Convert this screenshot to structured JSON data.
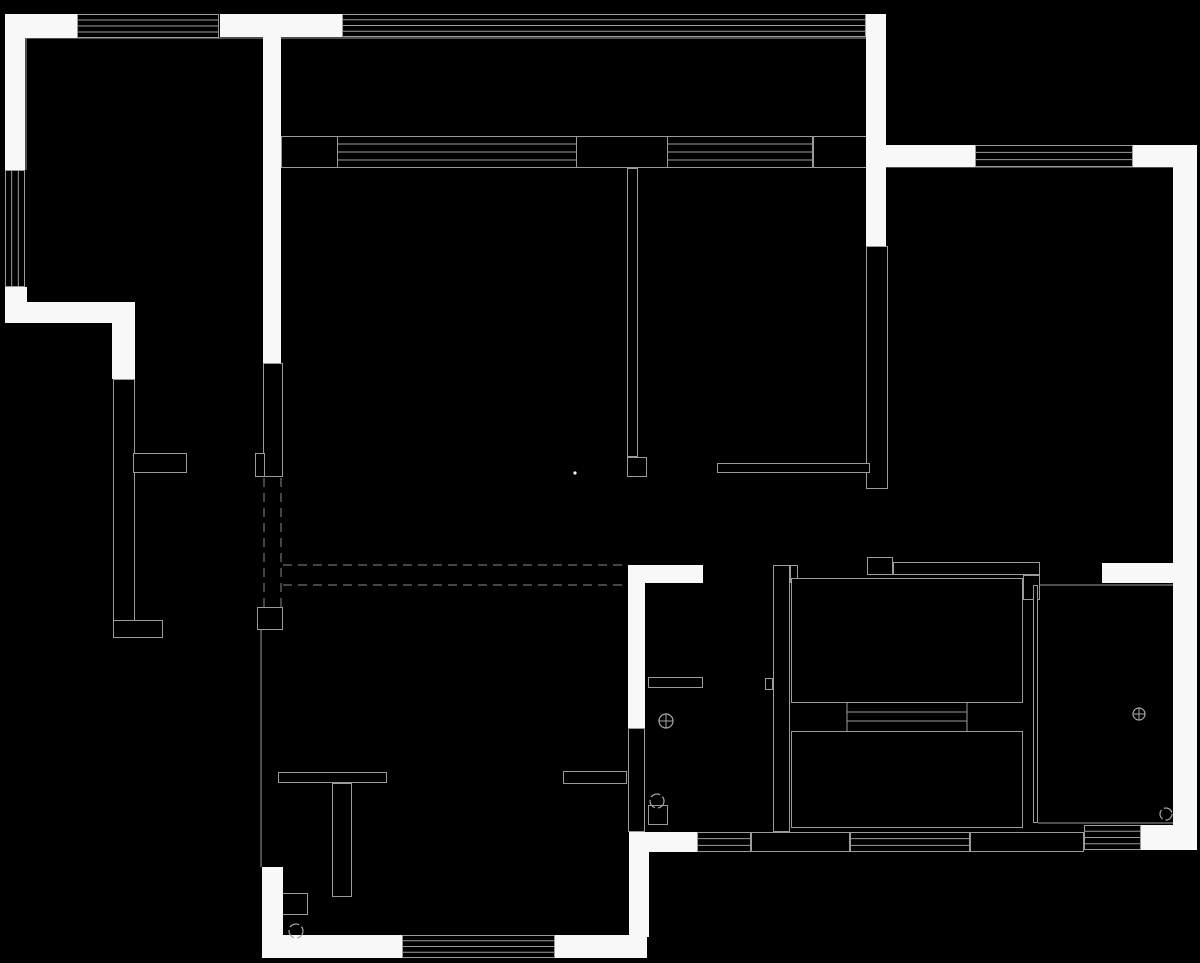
{
  "canvas": {
    "width": 1200,
    "height": 963
  },
  "colors": {
    "background": "#000000",
    "wall_fill": "#f8f8f8",
    "line": "#9b9b9b",
    "dash": "#8a8a8a",
    "symbol": "#a8a8a8"
  },
  "plan": {
    "white_walls": [
      [
        5,
        14,
        72,
        24
      ],
      [
        5,
        14,
        20,
        156
      ],
      [
        5,
        287,
        22,
        36
      ],
      [
        5,
        302,
        130,
        21
      ],
      [
        112,
        323,
        23,
        56
      ],
      [
        220,
        14,
        122,
        23
      ],
      [
        263,
        35,
        18,
        328
      ],
      [
        866,
        14,
        20,
        232
      ],
      [
        886,
        145,
        89,
        22
      ],
      [
        1133,
        145,
        60,
        22
      ],
      [
        1173,
        145,
        24,
        705
      ],
      [
        1102,
        563,
        71,
        20
      ],
      [
        1141,
        825,
        56,
        25
      ],
      [
        628,
        565,
        75,
        18
      ],
      [
        628,
        565,
        17,
        163
      ],
      [
        629,
        832,
        68,
        20
      ],
      [
        629,
        832,
        20,
        105
      ],
      [
        262,
        867,
        21,
        70
      ],
      [
        262,
        935,
        140,
        23
      ],
      [
        555,
        935,
        92,
        23
      ]
    ],
    "outlined_walls": [
      [
        113,
        379,
        22,
        259
      ],
      [
        133,
        453,
        54,
        20
      ],
      [
        113,
        620,
        50,
        18
      ],
      [
        263,
        363,
        20,
        114
      ],
      [
        255,
        453,
        10,
        24
      ],
      [
        257,
        607,
        26,
        23
      ],
      [
        627,
        168,
        11,
        289
      ],
      [
        627,
        457,
        20,
        20
      ],
      [
        866,
        246,
        22,
        243
      ],
      [
        717,
        463,
        153,
        10
      ],
      [
        867,
        557,
        26,
        18
      ],
      [
        893,
        562,
        147,
        13
      ],
      [
        1023,
        575,
        17,
        25
      ],
      [
        773,
        565,
        17,
        267
      ],
      [
        790,
        565,
        8,
        18
      ],
      [
        765,
        678,
        8,
        12
      ],
      [
        1033,
        585,
        5,
        238
      ],
      [
        648,
        677,
        55,
        11
      ],
      [
        628,
        728,
        17,
        104
      ],
      [
        648,
        805,
        20,
        20
      ],
      [
        751,
        832,
        99,
        20
      ],
      [
        970,
        832,
        114,
        20
      ],
      [
        278,
        772,
        109,
        11
      ],
      [
        332,
        783,
        20,
        114
      ],
      [
        278,
        893,
        30,
        22
      ],
      [
        563,
        771,
        64,
        13
      ],
      [
        813,
        136,
        55,
        32
      ],
      [
        791,
        578,
        232,
        125
      ],
      [
        791,
        731,
        232,
        97
      ]
    ],
    "open_rects": [
      [
        281,
        136,
        587,
        32
      ]
    ],
    "windows_h": [
      {
        "x": 77,
        "y": 14,
        "w": 142,
        "h": 24,
        "inner": 3
      },
      {
        "x": 342,
        "y": 14,
        "w": 524,
        "h": 23,
        "inner": 3
      },
      {
        "x": 337,
        "y": 136,
        "w": 240,
        "h": 32,
        "inner": 3
      },
      {
        "x": 667,
        "y": 136,
        "w": 146,
        "h": 32,
        "inner": 3
      },
      {
        "x": 975,
        "y": 145,
        "w": 158,
        "h": 22,
        "inner": 2
      },
      {
        "x": 697,
        "y": 832,
        "w": 54,
        "h": 20,
        "inner": 2
      },
      {
        "x": 850,
        "y": 832,
        "w": 120,
        "h": 20,
        "inner": 2
      },
      {
        "x": 1084,
        "y": 825,
        "w": 57,
        "h": 25,
        "inner": 3
      },
      {
        "x": 402,
        "y": 935,
        "w": 153,
        "h": 23,
        "inner": 3
      }
    ],
    "windows_v": [
      {
        "x": 5,
        "y": 170,
        "w": 20,
        "h": 117,
        "inner": 2
      }
    ],
    "lines": [
      [
        25,
        38,
        866,
        38
      ],
      [
        26,
        38,
        26,
        170
      ],
      [
        886,
        167,
        1173,
        167
      ],
      [
        1038,
        585,
        1173,
        585
      ],
      [
        1038,
        823,
        1173,
        823
      ],
      [
        847,
        712,
        967,
        712
      ],
      [
        847,
        721,
        967,
        721
      ],
      [
        847,
        703,
        847,
        731
      ],
      [
        967,
        703,
        967,
        731
      ],
      [
        261,
        630,
        261,
        867
      ]
    ],
    "dashed_lines": [
      [
        264,
        478,
        264,
        607
      ],
      [
        281,
        478,
        281,
        607
      ],
      [
        283,
        565,
        625,
        565
      ],
      [
        283,
        585,
        625,
        585
      ]
    ],
    "symbols": {
      "drains": [
        [
          666,
          721,
          7
        ],
        [
          1139,
          714,
          6
        ]
      ],
      "circles": [
        [
          657,
          801,
          7
        ],
        [
          1166,
          814,
          6
        ],
        [
          296,
          931,
          7
        ]
      ],
      "dots": [
        [
          575,
          473,
          1.6
        ]
      ]
    }
  }
}
